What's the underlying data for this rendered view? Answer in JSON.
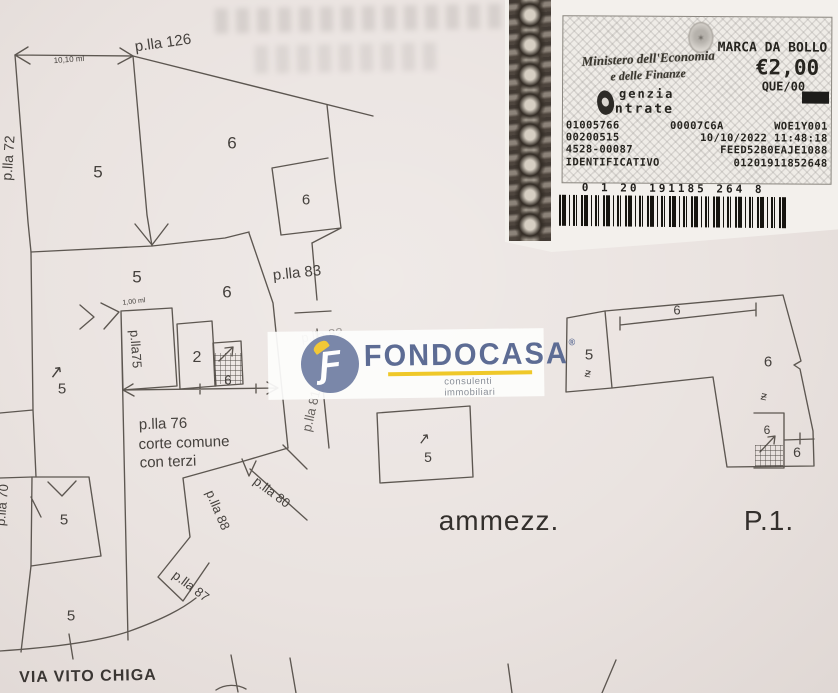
{
  "page": {
    "background": "#eae3e0",
    "line_color": "#5d5751"
  },
  "stamp": {
    "ministry_line1": "Ministero dell'Economia",
    "ministry_line2": "e delle Finanze",
    "title": "MARCA DA BOLLO",
    "amount": "€2,00",
    "office_code": "QUE/00",
    "agency_line1": "genzia",
    "agency_line2": "ntrate",
    "emblem_glyph": "✶",
    "rows": [
      {
        "c1": "01005766",
        "c2": "00007C6A",
        "c3": "WOE1Y001"
      },
      {
        "c1": "00200515",
        "c2": "10/10/2022 11:48:18"
      },
      {
        "c1": "4528-00087",
        "c2": "FEED52B0EAJE1088"
      },
      {
        "c1": "IDENTIFICATIVO",
        "c2": "01201911852648"
      }
    ],
    "barcode_digits": "0 1 20 191185 264 8"
  },
  "watermark": {
    "brand": "FONDOCASA",
    "registered": "®",
    "tagline": "consulenti immobiliari",
    "logo_letter": "Ƒ",
    "brand_color": "#5d6c94",
    "accent_color": "#efc829"
  },
  "captions": {
    "mezzanine": "ammezz.",
    "first_floor": "P.1.",
    "street": "VIA VITO CHIGA"
  },
  "plan": {
    "labels": [
      {
        "n": "parcel-126",
        "t": "p.lla 126",
        "x": 163,
        "y": 43,
        "r": -8,
        "s": 15
      },
      {
        "n": "dim-10-10-ml",
        "t": "10,10 ml",
        "x": 69,
        "y": 60,
        "r": -4,
        "s": 8
      },
      {
        "n": "parcel-72",
        "t": "p.lla 72",
        "x": 8,
        "y": 158,
        "r": -86,
        "s": 14
      },
      {
        "n": "room-5a",
        "t": "5",
        "x": 98,
        "y": 172,
        "s": 17
      },
      {
        "n": "room-6a",
        "t": "6",
        "x": 232,
        "y": 143,
        "s": 17
      },
      {
        "n": "room-5b",
        "t": "5",
        "x": 137,
        "y": 277,
        "s": 17
      },
      {
        "n": "room-6b",
        "t": "6",
        "x": 227,
        "y": 292,
        "s": 17
      },
      {
        "n": "room-6c",
        "t": "6",
        "x": 306,
        "y": 200,
        "s": 15
      },
      {
        "n": "parcel-83",
        "t": "p.lla 83",
        "x": 297,
        "y": 273,
        "r": -6,
        "s": 15
      },
      {
        "n": "parcel-75",
        "t": "p.lla75",
        "x": 136,
        "y": 349,
        "r": 86,
        "s": 13
      },
      {
        "n": "dim-1-00-ml",
        "t": "1,00 ml",
        "x": 134,
        "y": 302,
        "r": -7,
        "s": 7
      },
      {
        "n": "room-2a",
        "t": "2",
        "x": 197,
        "y": 358,
        "s": 16
      },
      {
        "n": "room-6d",
        "t": "6",
        "x": 228,
        "y": 380,
        "s": 13
      },
      {
        "n": "parcel-82",
        "t": "p.lla 82",
        "x": 322,
        "y": 335,
        "r": -8,
        "s": 13,
        "o": 0.45
      },
      {
        "n": "parcel-81",
        "t": "p.lla 81",
        "x": 311,
        "y": 411,
        "r": -77,
        "s": 13,
        "o": 0.8
      },
      {
        "n": "parcel-76",
        "t": "p.lla 76",
        "x": 163,
        "y": 424,
        "r": -2,
        "s": 15
      },
      {
        "n": "court-common-line",
        "t": "corte comune",
        "x": 184,
        "y": 443,
        "r": -2,
        "s": 15
      },
      {
        "n": "court-terzi-line",
        "t": "con terzi",
        "x": 168,
        "y": 462,
        "r": -2,
        "s": 15
      },
      {
        "n": "north-arrow-a",
        "t": "↗",
        "x": 56,
        "y": 372,
        "r": -8,
        "s": 17
      },
      {
        "n": "room-5c",
        "t": "5",
        "x": 62,
        "y": 389,
        "s": 15
      },
      {
        "n": "parcel-70",
        "t": "p.lla 70",
        "x": 2,
        "y": 505,
        "r": -85,
        "s": 13
      },
      {
        "n": "room-5d",
        "t": "5",
        "x": 64,
        "y": 520,
        "s": 15
      },
      {
        "n": "room-5e",
        "t": "5",
        "x": 71,
        "y": 616,
        "s": 15
      },
      {
        "n": "parcel-88",
        "t": "p.lla 88",
        "x": 218,
        "y": 510,
        "r": 67,
        "s": 13
      },
      {
        "n": "parcel-80",
        "t": "p.lla 80",
        "x": 272,
        "y": 492,
        "r": 37,
        "s": 13
      },
      {
        "n": "parcel-87",
        "t": "p.lla 87",
        "x": 191,
        "y": 586,
        "r": 37,
        "s": 13
      },
      {
        "n": "north-arrow-b",
        "t": "↗",
        "x": 424,
        "y": 439,
        "r": -8,
        "s": 15
      },
      {
        "n": "room-5f",
        "t": "5",
        "x": 428,
        "y": 457,
        "s": 14
      },
      {
        "n": "strip-room-6",
        "t": "6",
        "x": 677,
        "y": 310,
        "s": 13
      },
      {
        "n": "room-5g",
        "t": "5",
        "x": 589,
        "y": 355,
        "s": 15
      },
      {
        "n": "mark-z1",
        "t": "ƶ",
        "x": 588,
        "y": 373,
        "r": 12,
        "s": 12
      },
      {
        "n": "room-6e",
        "t": "6",
        "x": 768,
        "y": 362,
        "s": 15
      },
      {
        "n": "mark-z2",
        "t": "ƶ",
        "x": 764,
        "y": 396,
        "r": 12,
        "s": 12
      },
      {
        "n": "stairs-6",
        "t": "6",
        "x": 767,
        "y": 430,
        "s": 12
      },
      {
        "n": "room-6f",
        "t": "6",
        "x": 797,
        "y": 452,
        "s": 14
      }
    ]
  }
}
